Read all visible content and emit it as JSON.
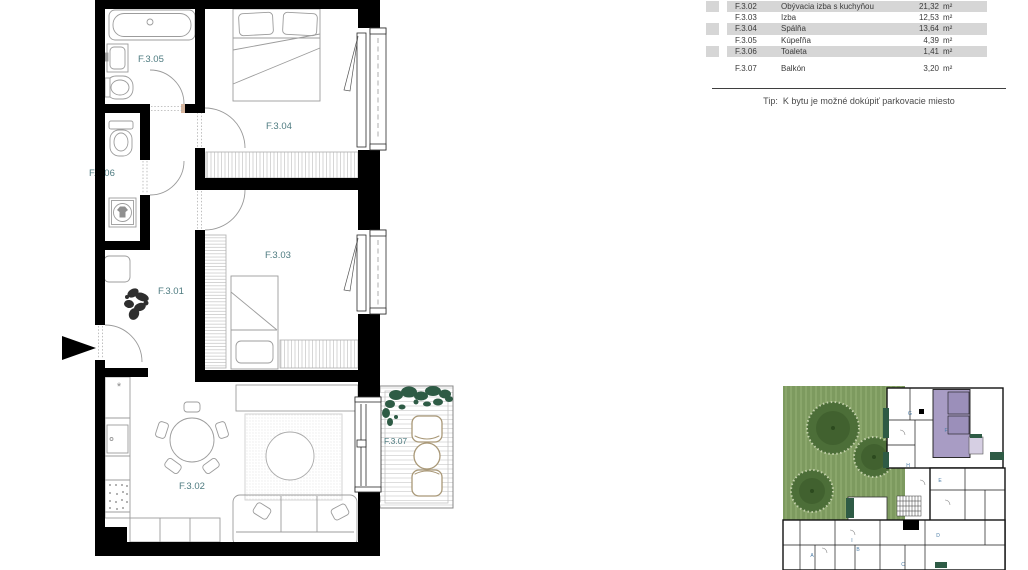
{
  "legend": {
    "rows": [
      {
        "code": "F.3.02",
        "name": "Obývacia izba s kuchyňou",
        "area": "21,32",
        "unit": "m²"
      },
      {
        "code": "F.3.03",
        "name": "Izba",
        "area": "12,53",
        "unit": "m²"
      },
      {
        "code": "F.3.04",
        "name": "Spálňa",
        "area": "13,64",
        "unit": "m²"
      },
      {
        "code": "F.3.05",
        "name": "Kúpeľňa",
        "area": "4,39",
        "unit": "m²"
      },
      {
        "code": "F.3.06",
        "name": "Toaleta",
        "area": "1,41",
        "unit": "m²"
      }
    ],
    "balcony_row": {
      "code": "F.3.07",
      "name": "Balkón",
      "area": "3,20",
      "unit": "m²"
    },
    "tip_label": "Tip:",
    "tip_text": "K bytu je možné dokúpiť parkovacie miesto"
  },
  "plan": {
    "rooms": {
      "f301": "F.3.01",
      "f302": "F.3.02",
      "f303": "F.3.03",
      "f304": "F.3.04",
      "f305": "F.3.05",
      "f306": "F.3.06",
      "f307": "F.3.07"
    }
  },
  "sitemap": {
    "units": [
      "G",
      "F",
      "H",
      "E",
      "D",
      "I",
      "B",
      "A",
      "C"
    ]
  },
  "colors": {
    "wall": "#000000",
    "room_label": "#4e7b80",
    "row_shade": "#d6d6d6",
    "furniture": "#9c9c9c",
    "grass": "#7d9a5f",
    "tree": "#4c6e38",
    "unit_highlight": "#a89cc4",
    "unit_balcony_highlight": "#d6cfe3",
    "plant_green": "#2e5b45",
    "balcony_furniture": "#a99877",
    "unit_letter": "#4a7ba6"
  }
}
